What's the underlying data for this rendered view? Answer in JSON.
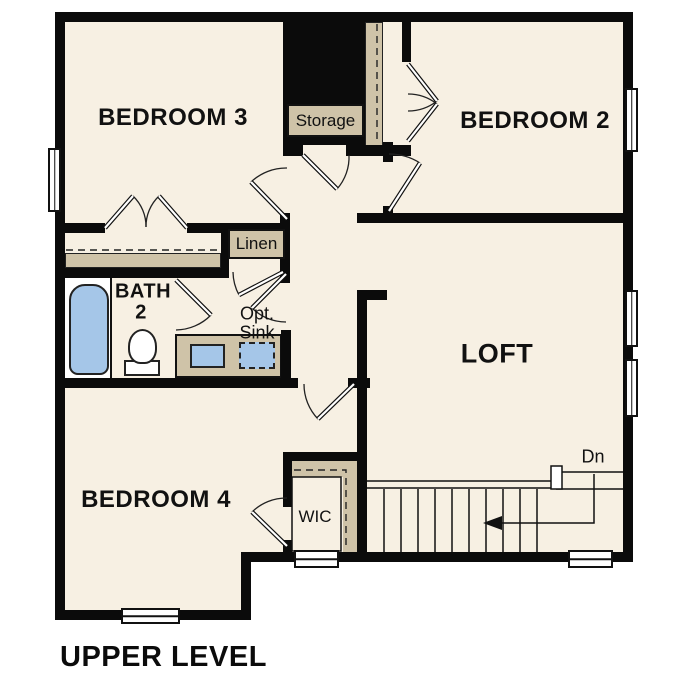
{
  "plan_title": "UPPER LEVEL",
  "palette": {
    "paper": "#ffffff",
    "floor": "#f7f0e3",
    "wall": "#0b0b0b",
    "cabinet": "#cfc3a8",
    "fixture_blue": "#a5c6e8"
  },
  "rooms": {
    "bedroom3": {
      "label": "BEDROOM 3"
    },
    "bedroom2": {
      "label": "BEDROOM 2"
    },
    "bedroom4": {
      "label": "BEDROOM 4"
    },
    "loft": {
      "label": "LOFT"
    },
    "bath2": {
      "line1": "BATH",
      "line2": "2"
    },
    "storage": {
      "label": "Storage"
    },
    "linen": {
      "label": "Linen"
    },
    "wic": {
      "label": "WIC"
    },
    "opt_sink": {
      "line1": "Opt.",
      "line2": "Sink"
    },
    "stairs": {
      "down_label": "Dn"
    }
  }
}
